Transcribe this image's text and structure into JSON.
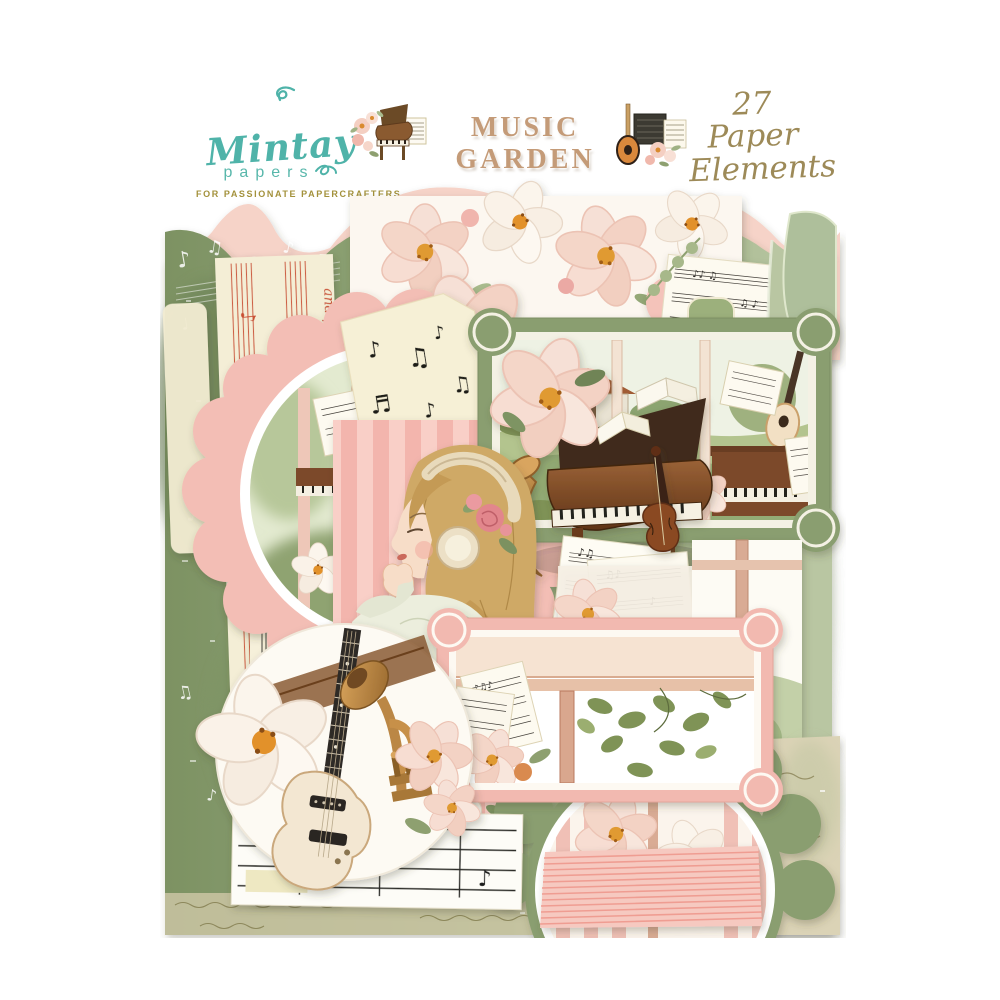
{
  "header": {
    "logo": {
      "brand": "Mintay",
      "word2": "papers",
      "tagline": "FOR PASSIONATE PAPERCRAFTERS"
    },
    "title": "MUSIC GARDEN",
    "count": {
      "line1": "27 Paper",
      "line2": "Elements"
    }
  },
  "stack": {
    "handwritten_text": "and play li"
  },
  "colors": {
    "logo_teal": "#4fb3a9",
    "tagline_gold": "#a3913b",
    "title_tan": "#c49b78",
    "count_olive": "#9d8a58",
    "pink_scallop": "#f3beb5",
    "green_paper": "#8a9e70",
    "cream_paper": "#f5efd6",
    "red_notation": "#c94f33",
    "background": "#ffffff"
  },
  "illustrations": {
    "title_left": "grand-piano-with-flowers-icon",
    "title_right": "electric-guitar-with-flowers-icon",
    "die_cuts": [
      "girl-with-headphones",
      "grand-piano",
      "upright-piano-window-scene",
      "electric-guitar",
      "trumpet",
      "violin",
      "saxophone",
      "sheet-music-pages",
      "rose-flowers",
      "magnolia-flowers"
    ]
  }
}
